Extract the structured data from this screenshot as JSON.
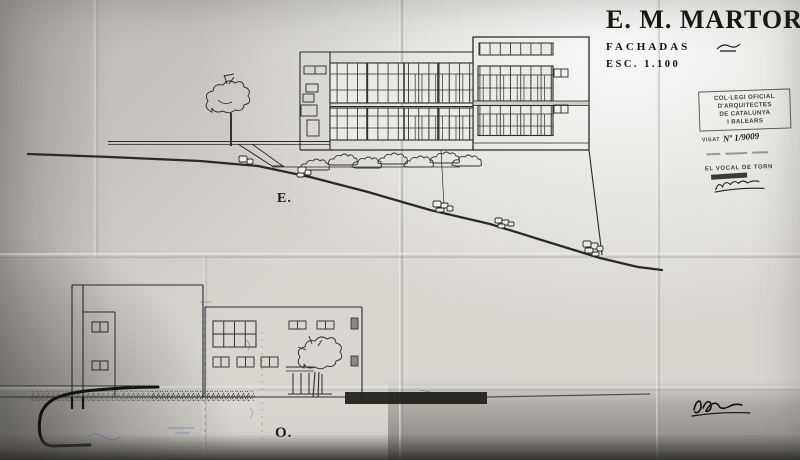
{
  "title_block": {
    "project": "E. M. MARTOREL",
    "drawing": "FACHADAS",
    "scale": "ESC.  1.100"
  },
  "labels": {
    "elevation_east": "E.",
    "elevation_west": "O."
  },
  "stamp": {
    "org_line1": "COL·LEGI OFICIAL",
    "org_line2": "D'ARQUITECTES",
    "org_line3": "DE CATALUNYA",
    "org_line4": "I BALEARS",
    "visat_label": "VISAT",
    "visat_number": "Nº 1/9009",
    "official_title": "EL VOCAL DE TORN"
  },
  "colors": {
    "paper": "#d9d6d0",
    "ink": "#2b2a27",
    "blue_pencil": "#6474bd"
  }
}
